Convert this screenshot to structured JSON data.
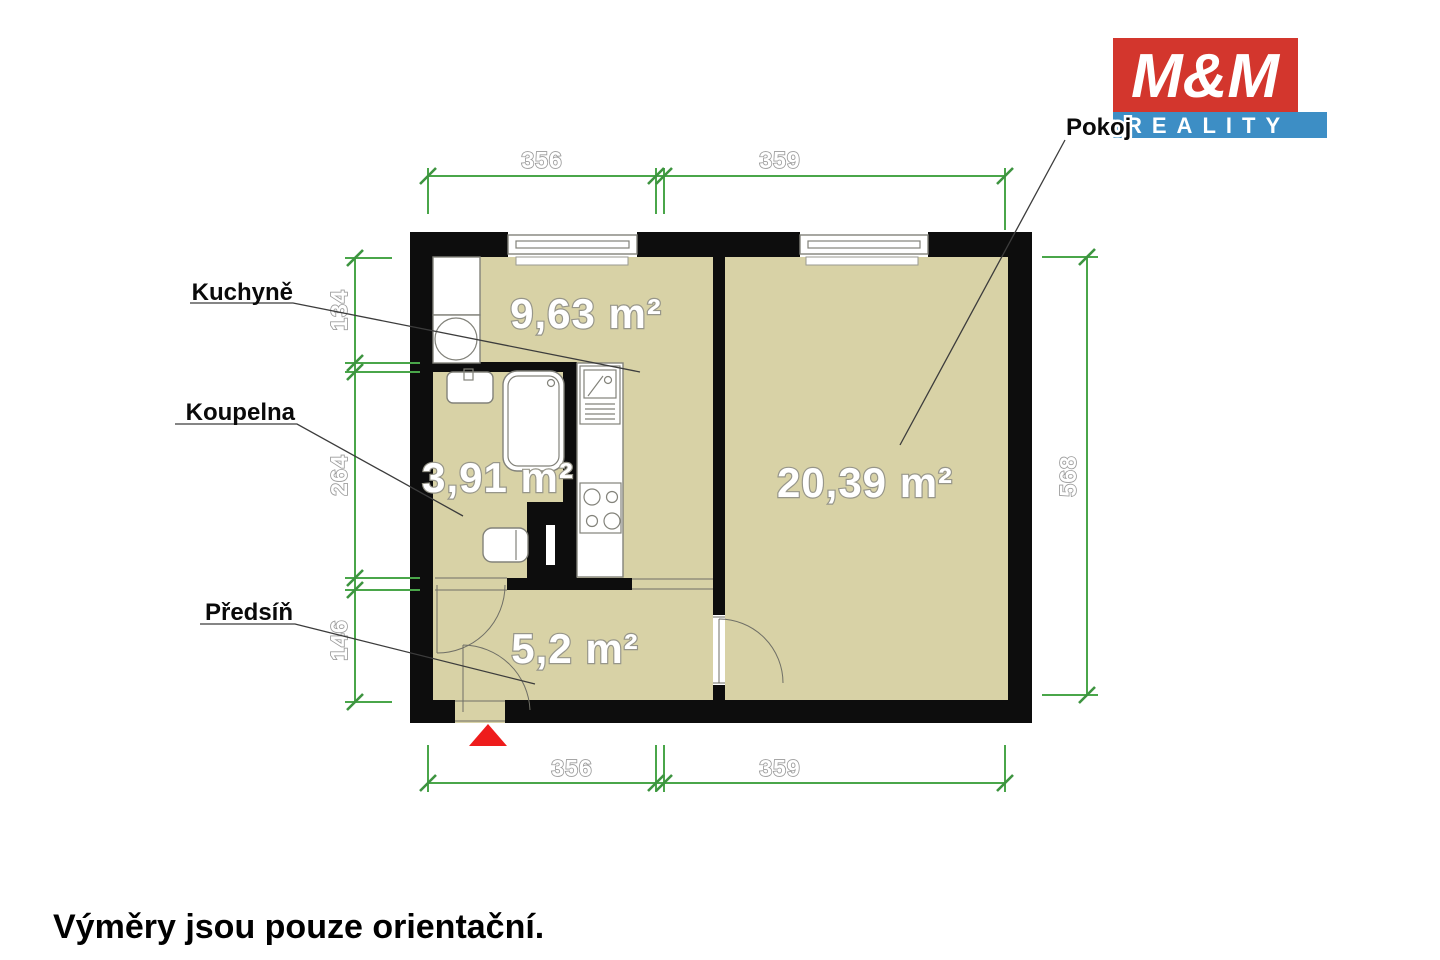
{
  "logo": {
    "mm": "M&M",
    "reality": "REALITY"
  },
  "rooms": {
    "kitchen": {
      "name": "Kuchyně",
      "area": "9,63 m²"
    },
    "bathroom": {
      "name": "Koupelna",
      "area": "3,91 m²"
    },
    "hall": {
      "name": "Předsíň",
      "area": "5,2 m²"
    },
    "room": {
      "name": "Pokoj",
      "area": "20,39 m²"
    }
  },
  "dims": {
    "top_left": "356",
    "top_right": "359",
    "bottom_left": "356",
    "bottom_right": "359",
    "left_top": "134",
    "left_mid": "264",
    "left_bottom": "146",
    "right": "568"
  },
  "disclaimer": "Výměry jsou pouze orientační.",
  "colors": {
    "floor": "#d8d2a6",
    "wall": "#0d0d0d",
    "dimension_green": "#4aa64a",
    "logo_red": "#d3362d",
    "logo_blue": "#3d8ec5",
    "entrance_marker": "#ee1c1c"
  }
}
